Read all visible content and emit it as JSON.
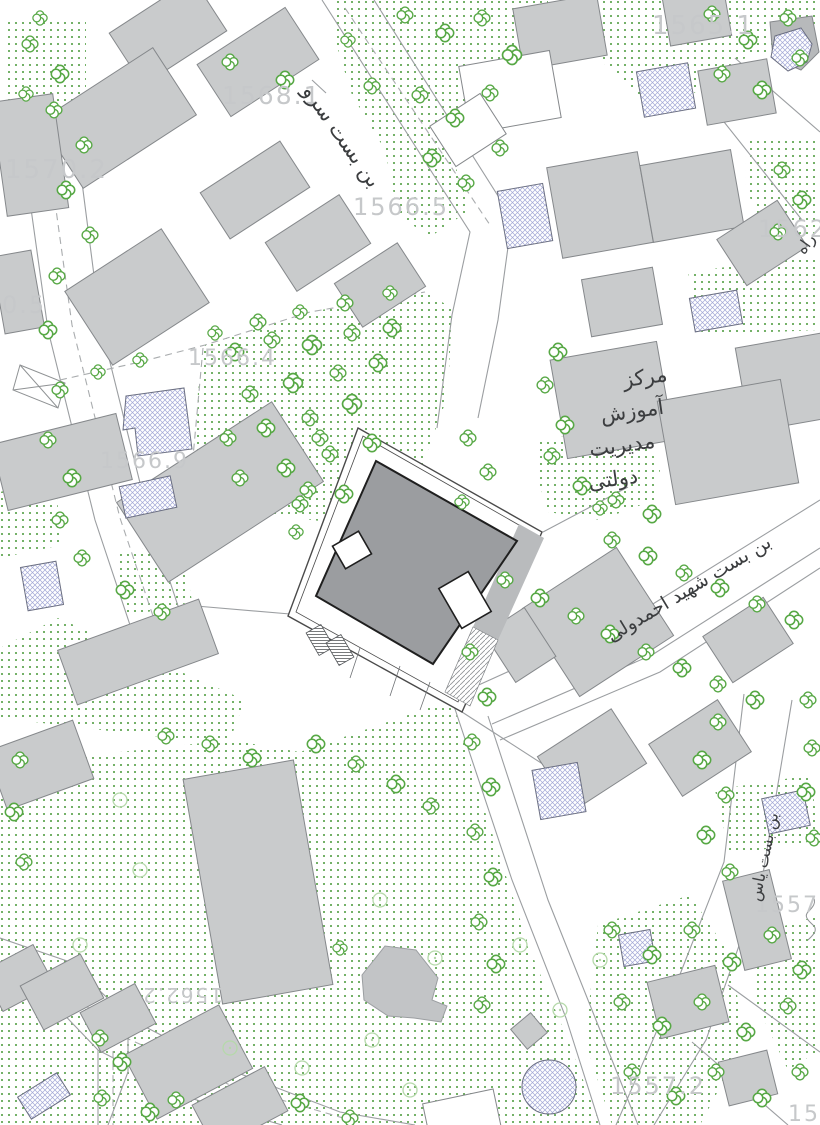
{
  "map": {
    "type": "architectural-site-plan",
    "labels": {
      "e1565": "1565.1",
      "e1568": "1568.1",
      "e1570": "1570.2",
      "e1566_5": "1566.5",
      "e1562": "1562",
      "e0_5": "0.5",
      "e1566_4": "1566.4",
      "e1566_9": "1566.9",
      "e1562_2": "1562.2",
      "e1557_3": "1557.3",
      "e1557_2": "1557.2",
      "e1557": "1557",
      "st_sarv": "بن بست سرو",
      "st_ahmadvali": "بن بست شهید احمدولی",
      "st_yas": "بن بست یاس",
      "st_rah": "راه",
      "poi1": "مرکز",
      "poi2": "آموزش",
      "poi3": "مدیریت",
      "poi4": "دولتی"
    },
    "colors": {
      "background": "#ffffff",
      "building_fill": "#c9cbcc",
      "building_stroke": "#85888b",
      "main_building_fill": "#9b9da0",
      "main_building_stroke": "#1f1f1f",
      "tree_green": "#57a845",
      "stipple_green": "#4e9c3e",
      "faint_tree_green": "#b5d9aa",
      "hatch_blue": "#a3a8d6",
      "hatch_outline": "#6b6f82",
      "elevation_text": "#c6c8ca",
      "street_text": "#3b3d3f",
      "road_line": "#9b9ea1"
    }
  }
}
